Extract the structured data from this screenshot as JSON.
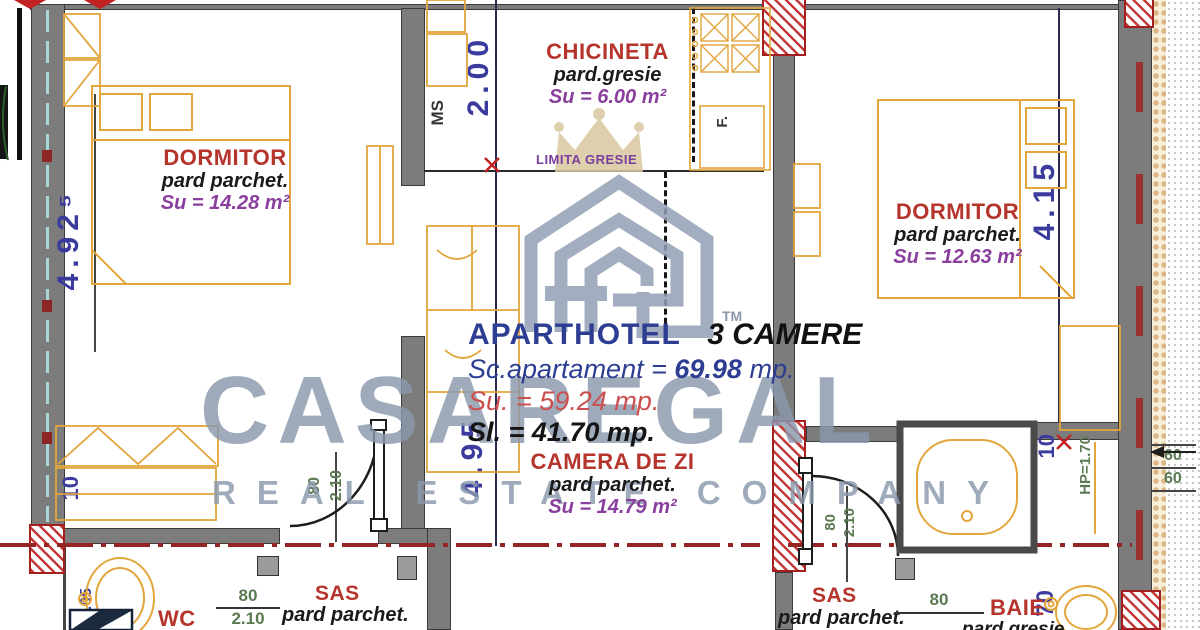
{
  "watermark": {
    "brand": "CASAREGAL",
    "tagline": "REAL ESTATE COMPANY",
    "tm": "TM"
  },
  "title_block": {
    "brand": "APARTHOTEL",
    "unit_type": "3 CAMERE",
    "sc_label": "Sc.apartament = ",
    "sc_value": "69.98",
    "sc_unit": " mp.",
    "su_line": "Su. = 59.24 mp.",
    "sl_line": "Sl. = 41.70 mp."
  },
  "annotations": {
    "limita_gresie": "LIMITA GRESIE",
    "washing_machine": "MS",
    "fridge": "F.",
    "parapet": "HP=1.70"
  },
  "rooms": {
    "dormitor_left": {
      "name": "DORMITOR",
      "floor": "pard parchet.",
      "area": "Su = 14.28 m²"
    },
    "chicineta": {
      "name": "CHICINETA",
      "floor": "pard.gresie",
      "area": "Su = 6.00 m²"
    },
    "dormitor_right": {
      "name": "DORMITOR",
      "floor": "pard parchet.",
      "area": "Su = 12.63 m²"
    },
    "camera_de_zi": {
      "name": "CAMERA DE ZI",
      "floor": "pard parchet.",
      "area": "Su = 14.79 m²"
    },
    "sas_left": {
      "name": "SAS",
      "floor": "pard parchet."
    },
    "sas_right": {
      "name": "SAS",
      "floor": "pard parchet."
    },
    "wc": {
      "name": "WC"
    },
    "baie": {
      "name": "BAIE",
      "floor": "pard gresie"
    }
  },
  "dimensions": {
    "dorm_left_h": "4.92⁵",
    "kitchen_w": "2.00",
    "dorm_right_h": "4.15",
    "living_h": "4.95",
    "offset_left": "10",
    "offset_right": "10",
    "wc_h": "2.05",
    "baie_w": "70",
    "door_w": "80",
    "door_h": "2.10",
    "wc_door_w": "80",
    "wc_door_h": "2.10",
    "sas_right_w": "80",
    "win_a": "60",
    "win_b": "60"
  },
  "colors": {
    "room_title": "#b5342c",
    "area_text": "#8a3f9e",
    "dim_meters": "#3b3b9d",
    "dim_cm": "#5c7a52",
    "furniture": "#e2a63d",
    "watermark": "#8c9aae",
    "section_line": "#952525"
  }
}
